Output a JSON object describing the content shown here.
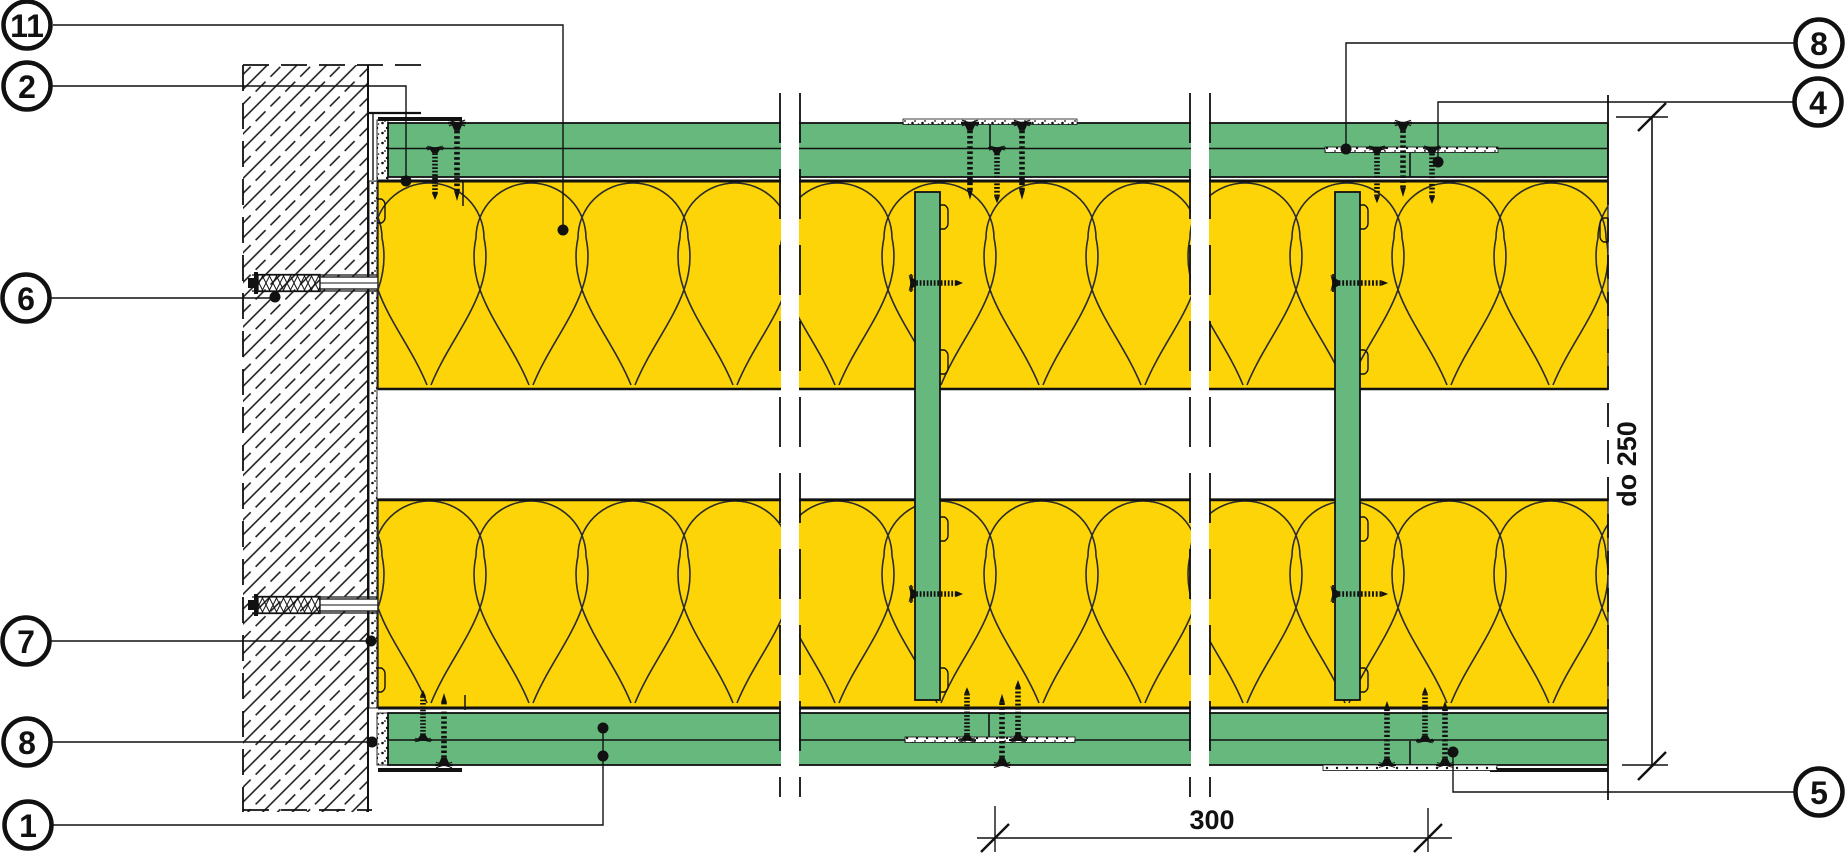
{
  "callouts": {
    "c11": "11",
    "c2": "2",
    "c6": "6",
    "c7": "7",
    "c8_left": "8",
    "c1": "1",
    "c8_right": "8",
    "c4": "4",
    "c5": "5"
  },
  "dimensions": {
    "height_limit": "do 250",
    "spacing": "300"
  },
  "colors": {
    "board_green": "#66b87c",
    "insulation_yellow": "#fcd407",
    "line": "#111111",
    "background": "#ffffff"
  }
}
